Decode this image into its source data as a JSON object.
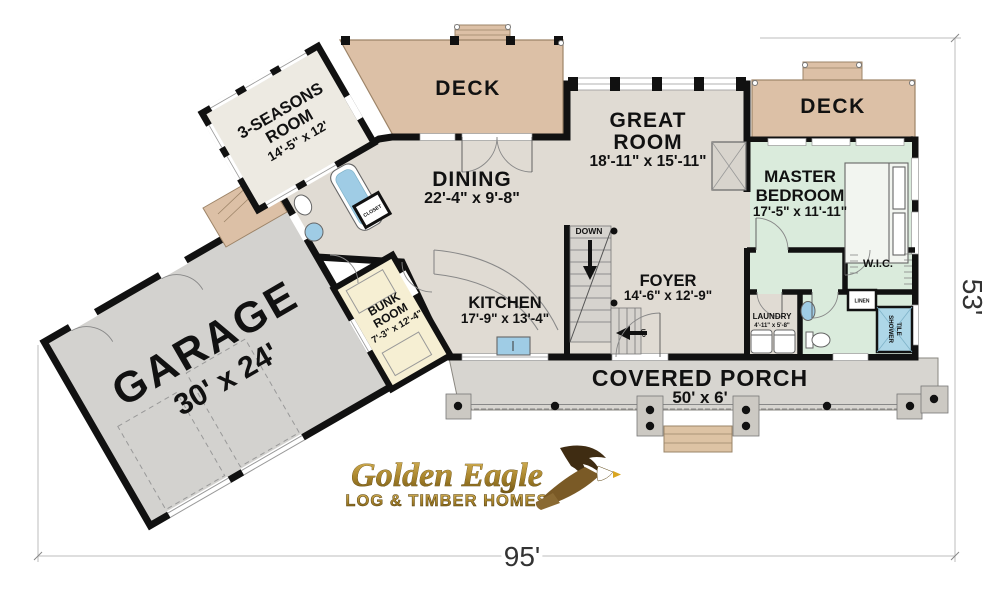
{
  "title": "Golden Eagle Log & Timber Homes floor plan",
  "rooms": {
    "deck_left": {
      "name": "DECK"
    },
    "deck_right": {
      "name": "DECK"
    },
    "three_seasons": {
      "line1": "3-SEASONS",
      "line2": "ROOM",
      "dims": "14'-5\" x 12'"
    },
    "great_room": {
      "line1": "GREAT",
      "line2": "ROOM",
      "dims": "18'-11\" x 15'-11\""
    },
    "dining": {
      "name": "DINING",
      "dims": "22'-4\" x 9'-8\""
    },
    "master": {
      "line1": "MASTER",
      "line2": "BEDROOM",
      "dims": "17'-5\" x 11'-11\""
    },
    "kitchen": {
      "name": "KITCHEN",
      "dims": "17'-9\" x 13'-4\""
    },
    "foyer": {
      "name": "FOYER",
      "dims": "14'-6\" x 12'-9\""
    },
    "bunk": {
      "line1": "BUNK",
      "line2": "ROOM",
      "dims": "7'-3\" x 12'-4\""
    },
    "garage": {
      "name": "GARAGE",
      "dims": "30' x 24'"
    },
    "porch": {
      "name": "COVERED PORCH",
      "dims": "50' x 6'"
    },
    "wic": {
      "name": "W.I.C."
    },
    "laundry": {
      "name": "LAUNDRY",
      "dims": "4'-11\" x 5'-8\""
    },
    "linen": {
      "name": "LINEN"
    },
    "tile_shower": {
      "line1": "TILE",
      "line2": "SHOWER"
    },
    "closet": {
      "name": "CLOSET"
    },
    "stairs": {
      "down": "DOWN",
      "up": "UP"
    }
  },
  "dimensions": {
    "width_label": "95'",
    "height_label": "53'"
  },
  "logo": {
    "line1": "Golden Eagle",
    "line2": "LOG & TIMBER HOMES"
  },
  "colors": {
    "wall": "#111111",
    "line": "#666666",
    "deck": "#dcc0a6",
    "interior": "#e0dbd3",
    "master_suite": "#daebdc",
    "bunk": "#f6efd3",
    "seasons": "#edeae2",
    "garage": "#d3d2cf",
    "porch": "#d7d5d0",
    "steps": "#ddc3a4",
    "stair": "#d6d3ce",
    "shower_tile": "#aed7e8",
    "water": "#9fcce5",
    "dim_line": "#bdbdbd",
    "gold_light": "#d9b65a",
    "gold_mid": "#a8842c",
    "gold_dark": "#6f5414",
    "eagle_dark": "#3f2c12",
    "eagle_mid": "#7a5a26"
  }
}
